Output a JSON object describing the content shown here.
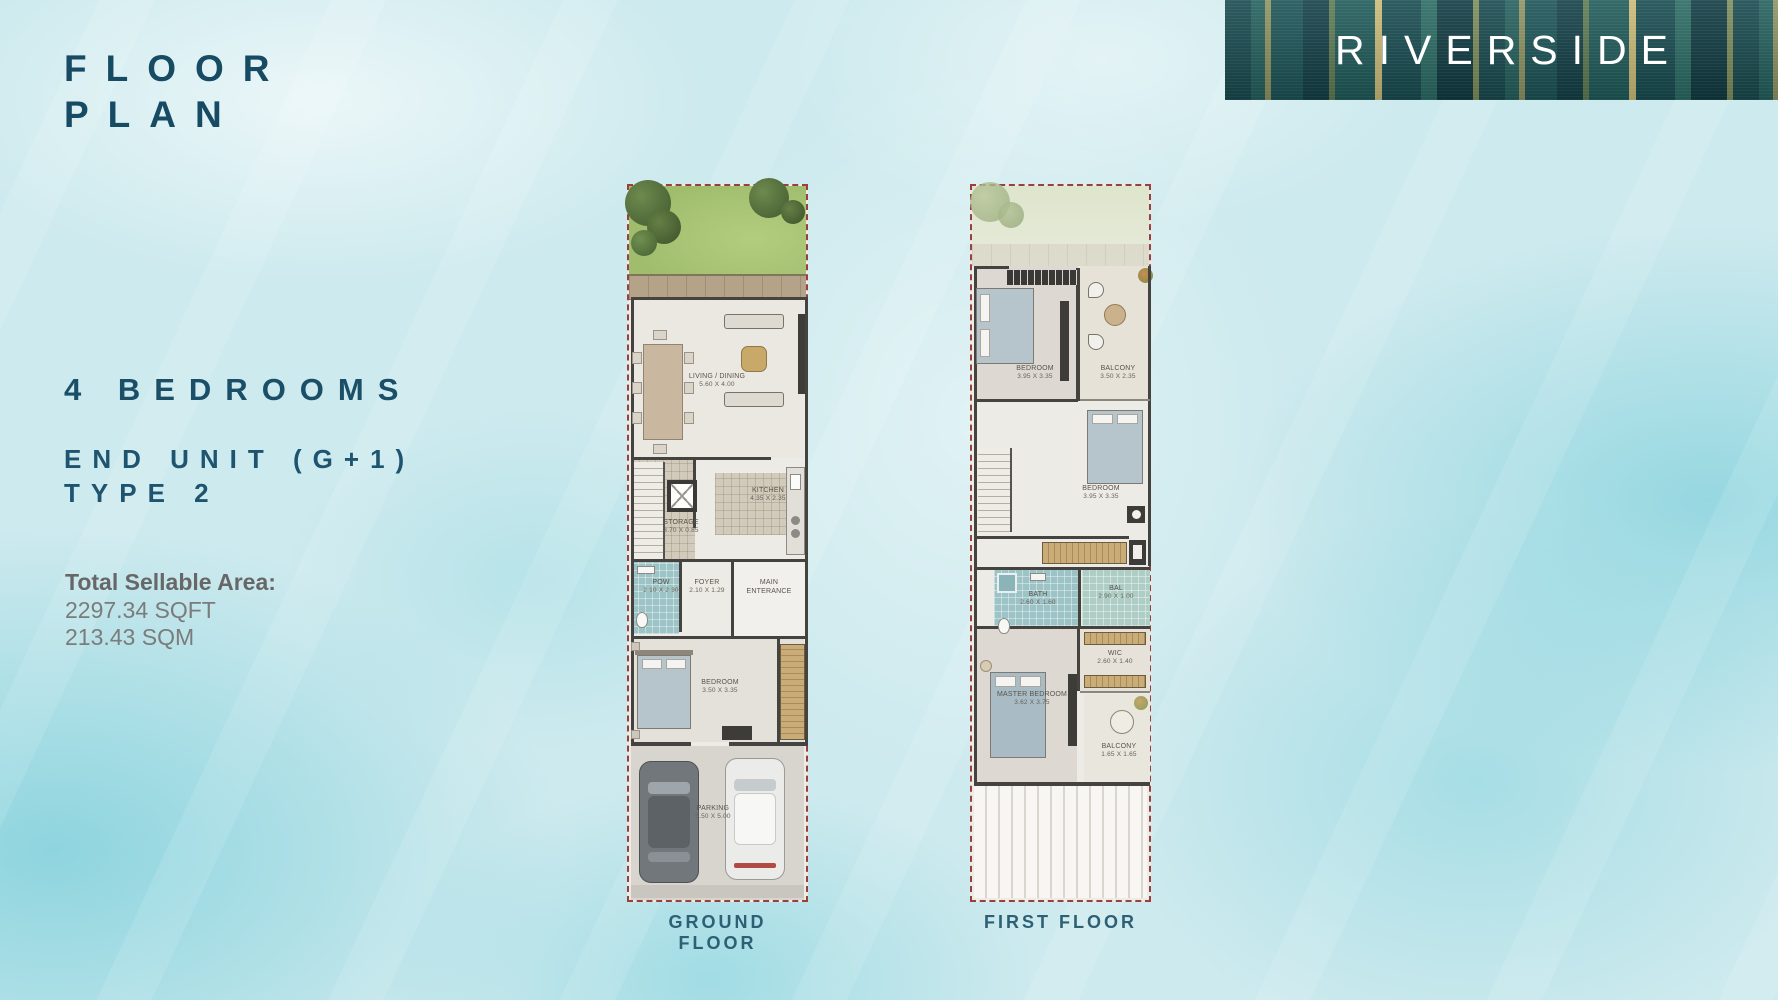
{
  "header": {
    "title_line1": "FLOOR",
    "title_line2": "PLAN",
    "brand": "RIVERSIDE"
  },
  "details": {
    "bedrooms_heading": "4 BEDROOMS",
    "unit_line1": "END UNIT (G+1)",
    "unit_line2": "TYPE 2",
    "area_label": "Total Sellable Area:",
    "area_sqft": "2297.34 SQFT",
    "area_sqm": "213.43 SQM"
  },
  "ground_floor": {
    "caption": "GROUND FLOOR",
    "living_dining": {
      "name": "LIVING / DINING",
      "dims": "5.60 X 4.00"
    },
    "storage": {
      "name": "STORAGE",
      "dims": "3.70 X 0.85"
    },
    "kitchen": {
      "name": "KITCHEN",
      "dims": "4.35 X 2.35"
    },
    "powder": {
      "name": "POW",
      "dims": "2.10 X 2.30"
    },
    "foyer": {
      "name": "FOYER",
      "dims": "2.10 X 1.29"
    },
    "entrance": {
      "name": "MAIN ENTERANCE",
      "dims": ""
    },
    "bedroom": {
      "name": "BEDROOM",
      "dims": "3.50 X 3.35"
    },
    "parking": {
      "name": "PARKING",
      "dims": "5.50 X 5.00"
    }
  },
  "first_floor": {
    "caption": "FIRST FLOOR",
    "bedroom1": {
      "name": "BEDROOM",
      "dims": "3.95 X 3.35"
    },
    "balcony1": {
      "name": "BALCONY",
      "dims": "3.50 X 2.35"
    },
    "bedroom2": {
      "name": "BEDROOM",
      "dims": "3.95 X 3.35"
    },
    "bath": {
      "name": "BATH",
      "dims": "2.60 X 1.60"
    },
    "bal": {
      "name": "BAL",
      "dims": "2.90 X 1.00"
    },
    "wic": {
      "name": "WIC",
      "dims": "2.60 X 1.40"
    },
    "master": {
      "name": "MASTER BEDROOM",
      "dims": "3.62 X 3.75"
    },
    "balcony2": {
      "name": "BALCONY",
      "dims": "1.65 X 1.65"
    }
  },
  "colors": {
    "accent_teal": "#174a63",
    "brand_banner": "#1b5356",
    "plan_border": "#99403e",
    "body_gray": "#7b7b7b",
    "garden_green": "#a5c272"
  }
}
